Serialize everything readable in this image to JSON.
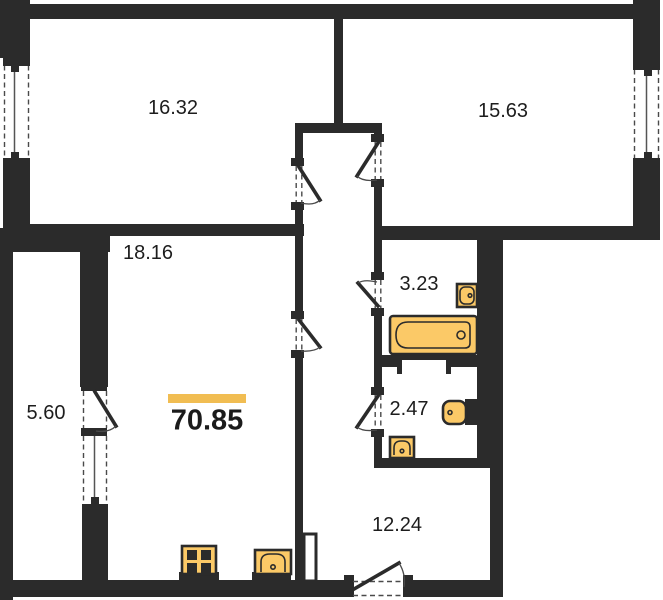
{
  "plan": {
    "total": {
      "area_label": "70.85"
    },
    "rooms": [
      {
        "name": "room-top-left",
        "area_label": "16.32"
      },
      {
        "name": "room-top-right",
        "area_label": "15.63"
      },
      {
        "name": "living-room",
        "area_label": "18.16"
      },
      {
        "name": "balcony",
        "area_label": "5.60"
      },
      {
        "name": "bathroom",
        "area_label": "3.23"
      },
      {
        "name": "toilet",
        "area_label": "2.47"
      },
      {
        "name": "hall-kitchen",
        "area_label": "12.24"
      }
    ],
    "colors": {
      "wall": "#2B2B2B",
      "fixture_fill": "#FBC967",
      "accent_bar": "#F1BD52",
      "background": "#FFFFFF"
    },
    "fixtures": [
      {
        "name": "bathtub",
        "room": "bathroom"
      },
      {
        "name": "washbasin",
        "room": "bathroom"
      },
      {
        "name": "toilet-bowl",
        "room": "toilet"
      },
      {
        "name": "washbasin",
        "room": "toilet"
      },
      {
        "name": "stove",
        "room": "living-room"
      },
      {
        "name": "kitchen-sink",
        "room": "living-room"
      }
    ]
  }
}
